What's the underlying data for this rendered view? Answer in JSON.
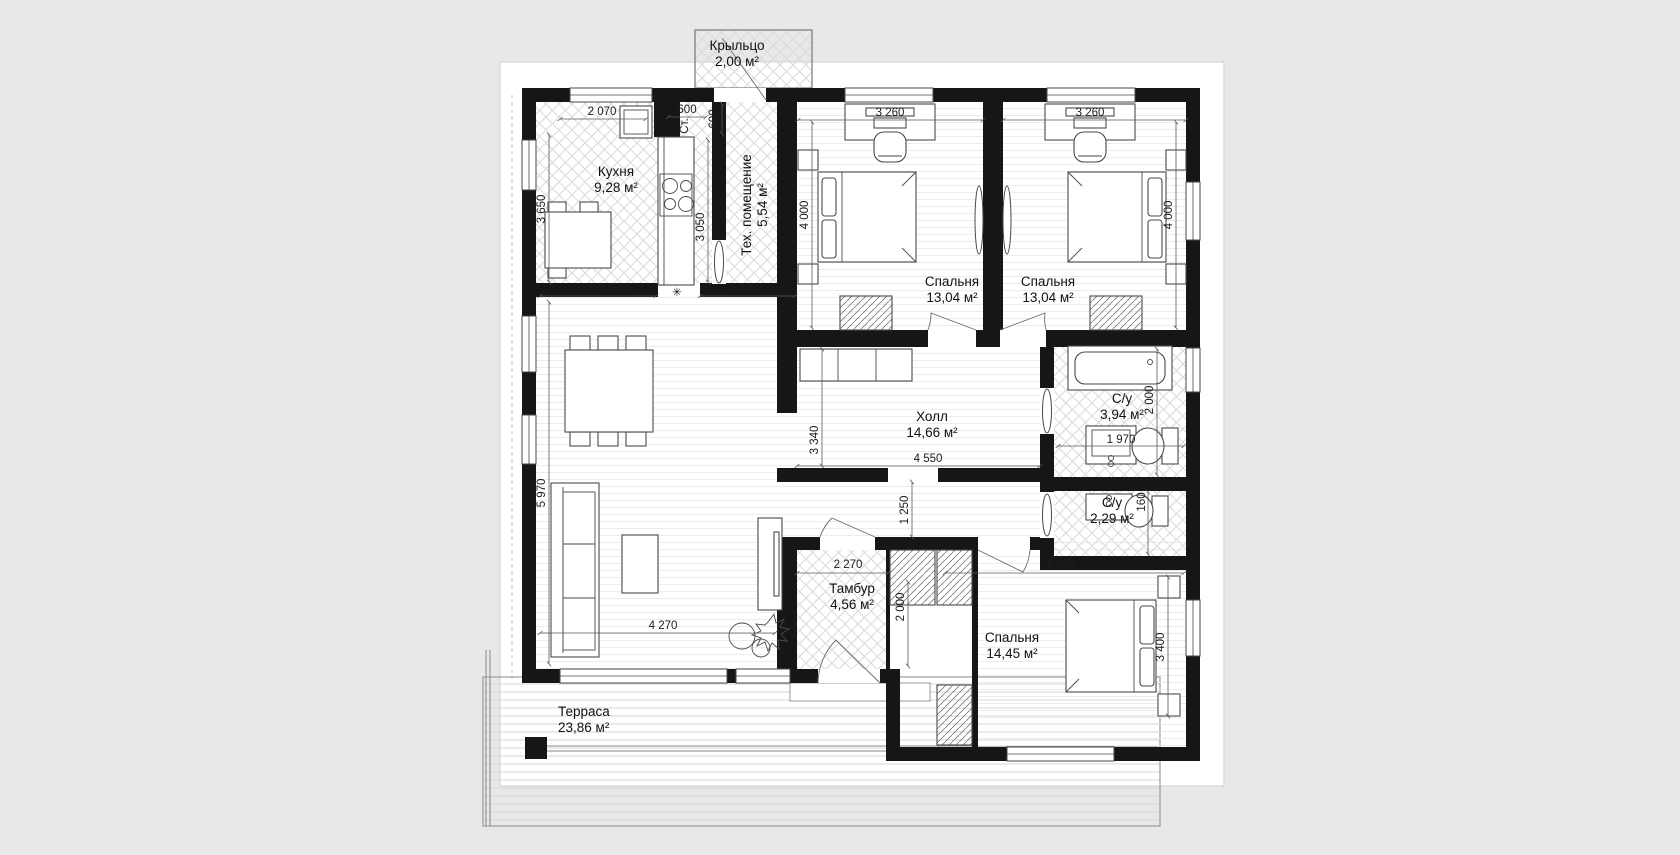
{
  "meta": {
    "type": "architectural floor plan",
    "background_color": "#e8e8e8",
    "paper_color": "#ffffff",
    "wall_color": "#161616"
  },
  "plan": {
    "rooms": [
      {
        "id": "porch",
        "name": "Крыльцо",
        "area": "2,00 м²"
      },
      {
        "id": "kitchen",
        "name": "Кухня",
        "area": "9,28 м²"
      },
      {
        "id": "tech",
        "name": "Тех. помещение",
        "area": "5,54 м²"
      },
      {
        "id": "bedroom1",
        "name": "Спальня",
        "area": "13,04 м²"
      },
      {
        "id": "bedroom2",
        "name": "Спальня",
        "area": "13,04 м²"
      },
      {
        "id": "hall",
        "name": "Холл",
        "area": "14,66 м²"
      },
      {
        "id": "bath1",
        "name": "С/у",
        "area": "3,94 м²"
      },
      {
        "id": "bath2",
        "name": "С/у",
        "area": "2,29 м²"
      },
      {
        "id": "vestibule",
        "name": "Тамбур",
        "area": "4,56 м²"
      },
      {
        "id": "bedroom3",
        "name": "Спальня",
        "area": "14,45 м²"
      },
      {
        "id": "terrace",
        "name": "Терраса",
        "area": "23,86 м²"
      }
    ],
    "dims": {
      "kitchen_window": "2 070",
      "washer_width": "600",
      "tech_door_width": "600",
      "kitchen_height": "3 650",
      "kitchen_counter_height": "3 050",
      "kitchen_width": "2 670",
      "tech_width": "1 420",
      "bedroom1_width": "3 260",
      "bedroom1_height": "4 000",
      "bedroom2_width": "3 260",
      "bedroom2_height": "4 000",
      "hall_height": "3 340",
      "hall_width": "4 550",
      "passage_height": "1 250",
      "bath1_height": "2 000",
      "bath1_width": "1 970",
      "bath2_height": "160",
      "vestibule_width": "2 270",
      "vestibule_height": "2 000",
      "bedroom3_width": "4 250",
      "bedroom3_height": "3 400",
      "living_width": "4 270",
      "living_height": "5 970"
    },
    "washer_label": "Ст.",
    "symbols": {
      "kitchen_star": "✳"
    }
  }
}
